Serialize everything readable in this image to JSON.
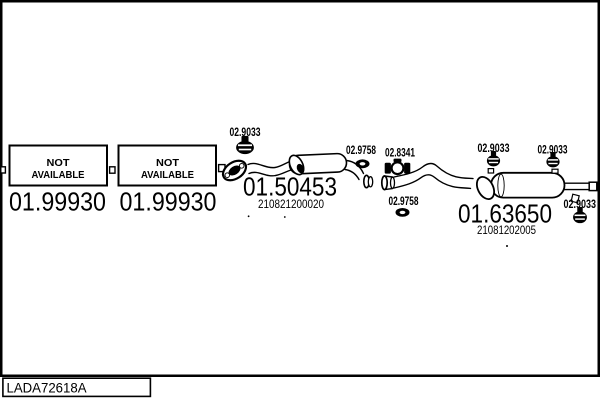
{
  "page": {
    "catalog_code": "LADA72618A",
    "background": "#ffffff",
    "line_color": "#000000"
  },
  "unavailable": {
    "box1": {
      "line1": "NOT",
      "line2": "AVAILABLE",
      "part": "01.99930"
    },
    "box2": {
      "line1": "NOT",
      "line2": "AVAILABLE",
      "part": "01.99930"
    }
  },
  "parts": {
    "center_muffler": {
      "part": "01.50453",
      "oem": "210821200020"
    },
    "rear_muffler": {
      "part": "01.63650",
      "oem": "21081202005"
    },
    "hanger1": "02.9033",
    "hanger2": "02.9033",
    "hanger3": "02.9033",
    "hanger4": "02.9033",
    "gasket1": "02.9758",
    "gasket2": "02.9758",
    "clamp": "02.8341"
  },
  "icons": {
    "hanger": "rubber-hanger-icon",
    "gasket": "gasket-ring-icon",
    "clamp": "pipe-clamp-icon",
    "flange": "exhaust-flange-icon"
  }
}
